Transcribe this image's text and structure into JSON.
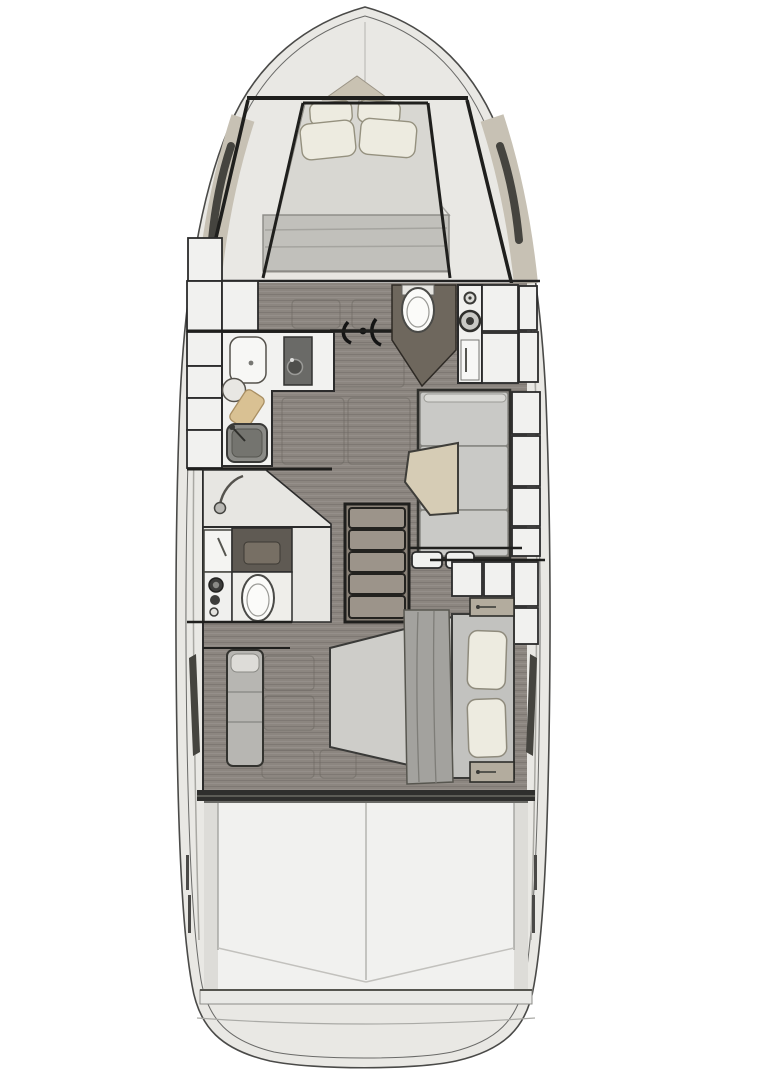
{
  "meta": {
    "title": "Yacht interior floor plan, top-down deck view",
    "visible_text": "none"
  },
  "regions": {
    "hull": "hull-outline",
    "bowDeck": "bow deck",
    "forwardCabin": "forward cabin with V-berth and pillows",
    "galley": "galley with sink, cooktop and cutting board",
    "salonFloor": "salon wood floor with hatches",
    "starboardHead": "forward head compartment with toilet",
    "helmConsole": "console with gauges",
    "dinette": "dinette sofa with table",
    "portHead": "mid head with shower, vanity, washer and toilet",
    "stairs": "companionway stairs to aft cabin",
    "aftCabin": "aft cabin with athwartships double berth",
    "bench": "aft cabin bench seat",
    "cockpit": "cockpit",
    "swimPlatform": "swim platform"
  },
  "colors": {
    "hull": "#e9e8e4",
    "hullStroke": "#4a4a48",
    "innerStroke": "#6a6a68",
    "deckBand": "#c7c1b4",
    "bowTriangle": "#c9c2b2",
    "frame": "#1f1f1d",
    "wood": "#8c8680",
    "white": "#f1f1ef",
    "offwhite": "#e7e6e2",
    "counter": "#f2f2f0",
    "appliance": "#6a6a67",
    "sinkDark": "#8b8b87",
    "sinkInner": "#74746f",
    "board": "#d9c193",
    "toilet": "#fbfbf9",
    "headWall": "#6e675d",
    "mattressFore": "#d8d7d2",
    "blanketFore": "#c1c0bb",
    "pillow": "#edebe0",
    "mattressAft": "#cecdc9",
    "blanketAft": "#a3a29e",
    "bedBase": "#c2c2bf",
    "cushion": "#c9c9c6",
    "cushionLight": "#dadad6",
    "table": "#d6ccb5",
    "stairsWood": "#9c948a",
    "stairsFrame": "#8a8278",
    "bench": "#b7b6b2",
    "benchPad": "#dddcd8",
    "nightstand": "#b3ac9e",
    "cockpitFloor": "#f1f1ef",
    "cockpitWall": "#dddcd8",
    "windowDark": "#45443f",
    "bulkhead": "#2f2f2d",
    "gauge": "#3a3a37"
  }
}
